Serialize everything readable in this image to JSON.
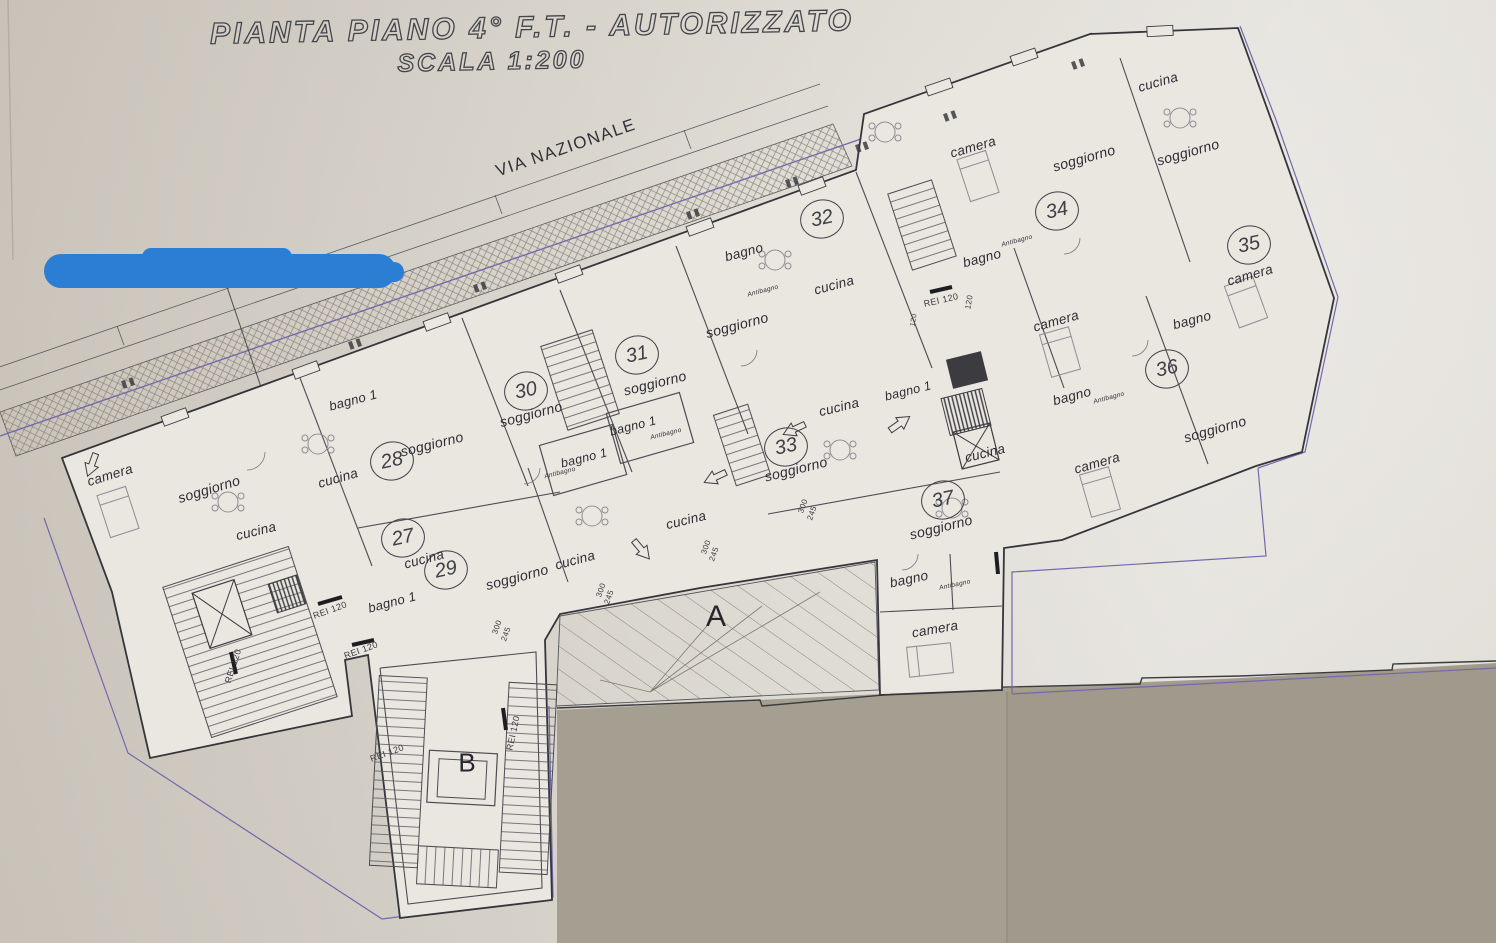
{
  "title": {
    "line1": "PIANTA PIANO 4° F.T. - AUTORIZZATO",
    "line2": "SCALA 1:200"
  },
  "street": {
    "name": "VIA NAZIONALE"
  },
  "zones": {
    "terrace_label": "A",
    "stair_block_label": "B"
  },
  "units": [
    {
      "n": "27"
    },
    {
      "n": "28"
    },
    {
      "n": "29"
    },
    {
      "n": "30"
    },
    {
      "n": "31"
    },
    {
      "n": "32"
    },
    {
      "n": "33"
    },
    {
      "n": "34"
    },
    {
      "n": "35"
    },
    {
      "n": "36"
    },
    {
      "n": "37"
    }
  ],
  "rooms": [
    {
      "t": "camera"
    },
    {
      "t": "soggiorno"
    },
    {
      "t": "cucina"
    },
    {
      "t": "bagno 1"
    },
    {
      "t": "cucina"
    },
    {
      "t": "soggiorno"
    },
    {
      "t": "cucina"
    },
    {
      "t": "soggiorno"
    },
    {
      "t": "bagno 1"
    },
    {
      "t": "soggiorno"
    },
    {
      "t": "cucina"
    },
    {
      "t": "bagno 1"
    },
    {
      "t": "Antibagno"
    },
    {
      "t": "bagno 1"
    },
    {
      "t": "Antibagno"
    },
    {
      "t": "soggiorno"
    },
    {
      "t": "cucina"
    },
    {
      "t": "soggiorno"
    },
    {
      "t": "bagno"
    },
    {
      "t": "Antibagno"
    },
    {
      "t": "cucina"
    },
    {
      "t": "soggiorno"
    },
    {
      "t": "cucina"
    },
    {
      "t": "bagno 1"
    },
    {
      "t": "camera"
    },
    {
      "t": "soggiorno"
    },
    {
      "t": "bagno"
    },
    {
      "t": "Antibagno"
    },
    {
      "t": "cucina"
    },
    {
      "t": "soggiorno"
    },
    {
      "t": "camera"
    },
    {
      "t": "bagno"
    },
    {
      "t": "camera"
    },
    {
      "t": "bagno"
    },
    {
      "t": "Antibagno"
    },
    {
      "t": "camera"
    },
    {
      "t": "soggiorno"
    },
    {
      "t": "cucina"
    },
    {
      "t": "soggiorno"
    },
    {
      "t": "bagno"
    },
    {
      "t": "Antibagno"
    },
    {
      "t": "camera"
    }
  ],
  "fire": [
    {
      "t": "REI 120"
    },
    {
      "t": "REI 120"
    },
    {
      "t": "REI 120"
    },
    {
      "t": "REI 120"
    },
    {
      "t": "REI 120"
    },
    {
      "t": "REI 120"
    },
    {
      "t": "120"
    },
    {
      "t": "120"
    }
  ],
  "dims": [
    {
      "t": "300"
    },
    {
      "t": "245"
    },
    {
      "t": "300"
    },
    {
      "t": "245"
    },
    {
      "t": "300"
    },
    {
      "t": "245"
    },
    {
      "t": "300"
    },
    {
      "t": "245"
    }
  ],
  "colors": {
    "paper": "#d9d3cb",
    "ink": "#3b3b40",
    "boundary_purple": "#7468ad",
    "marker_blue": "#2b7ed3",
    "gray_area": "#a59f91"
  }
}
